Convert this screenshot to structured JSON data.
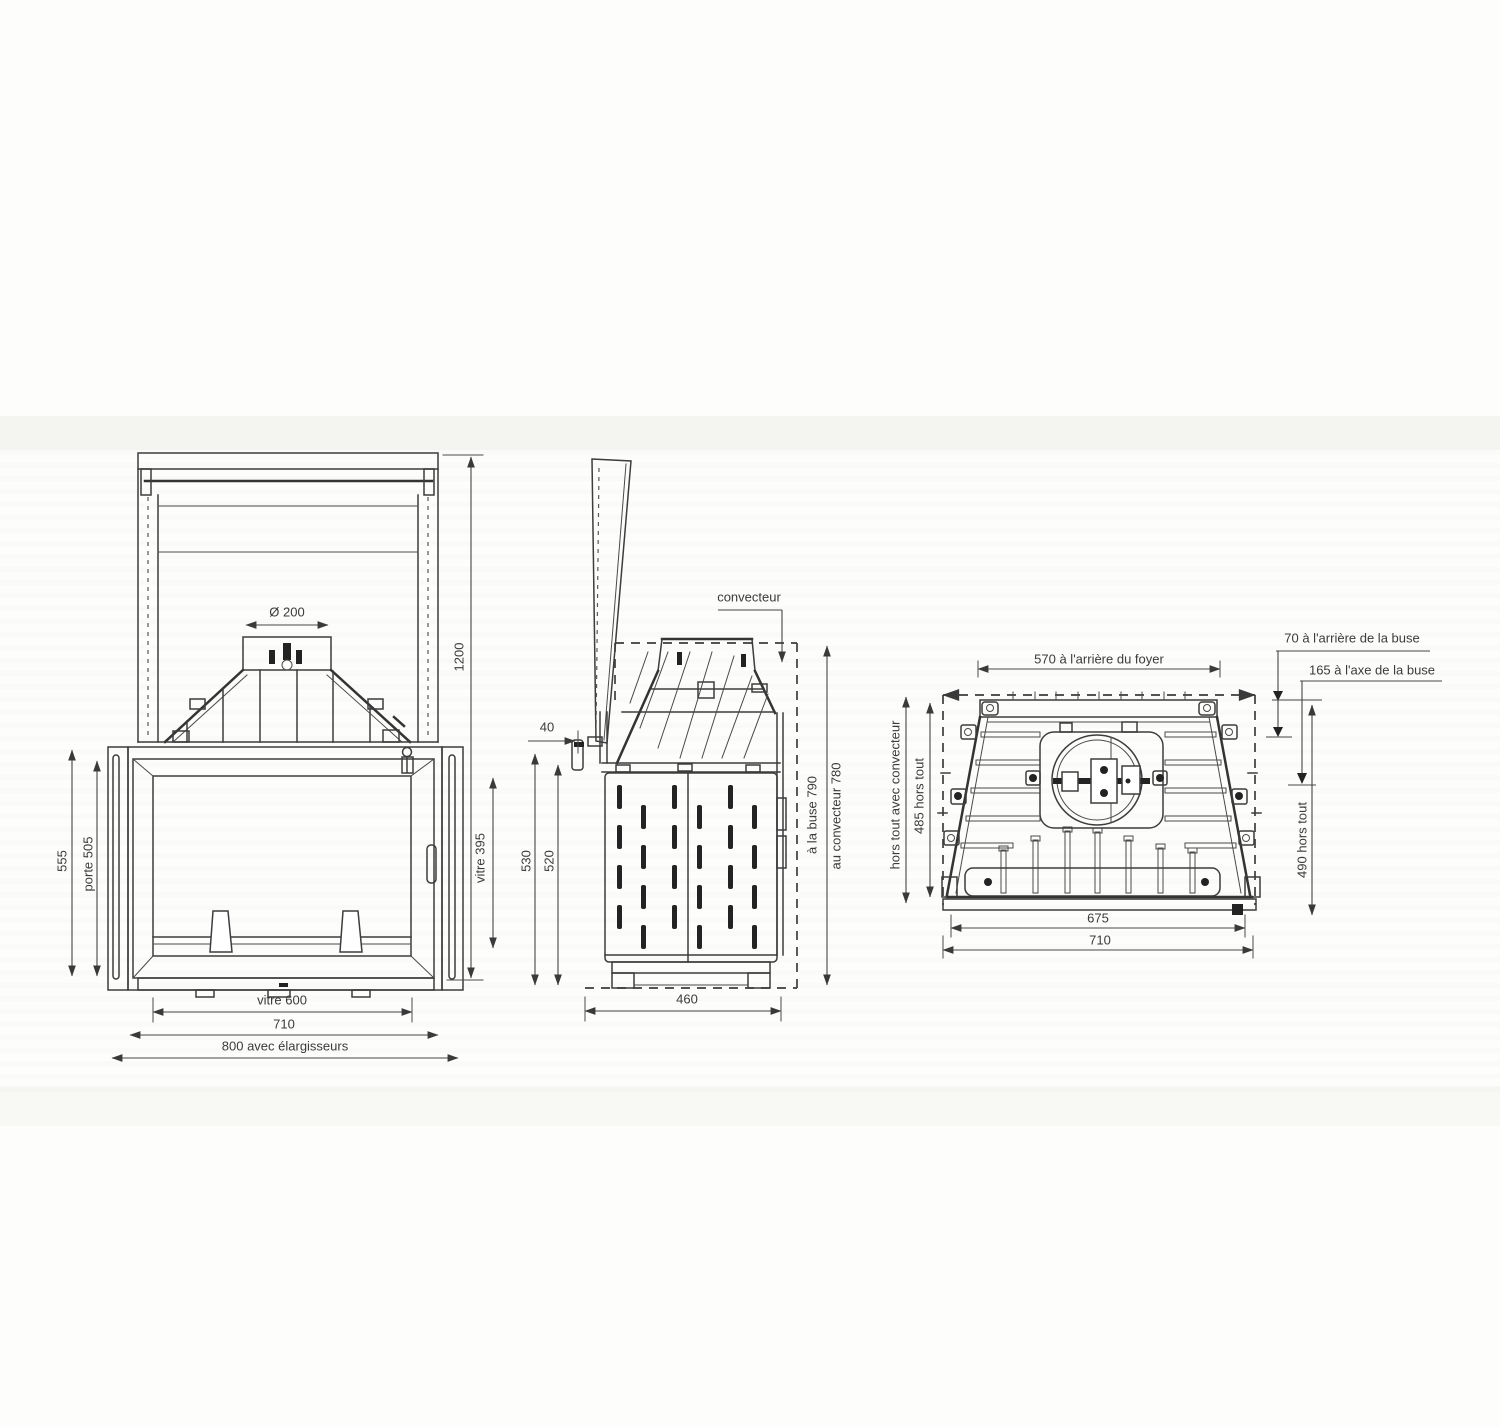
{
  "drawing": {
    "front": {
      "flue_diameter": "Ø 200",
      "total_height": "1200",
      "overall_height": "555",
      "door_height": "porte 505",
      "glass_height": "vitre 395",
      "glass_width": "vitre 600",
      "body_width": "710",
      "width_with_extensions": "800 avec élargisseurs"
    },
    "side": {
      "convector_label": "convecteur",
      "door_gap": "40",
      "front_height": "530",
      "frame_height": "520",
      "flue_height": "à la buse 790",
      "convector_height": "au convecteur 780",
      "depth": "460"
    },
    "top": {
      "rear_firebox_width": "570 à l'arrière du foyer",
      "flue_rear_offset": "70 à l'arrière de la buse",
      "flue_axis_offset": "165 à l'axe de la buse",
      "overall_depth_with_convector": "hors tout avec convecteur",
      "overall_depth": "485 hors tout",
      "overall_depth_max": "490 hors tout",
      "front_width_inner": "675",
      "front_width": "710"
    },
    "colors": {
      "line": "#3d3d3d",
      "dim": "#464646",
      "background": "#fdfdfc"
    }
  }
}
